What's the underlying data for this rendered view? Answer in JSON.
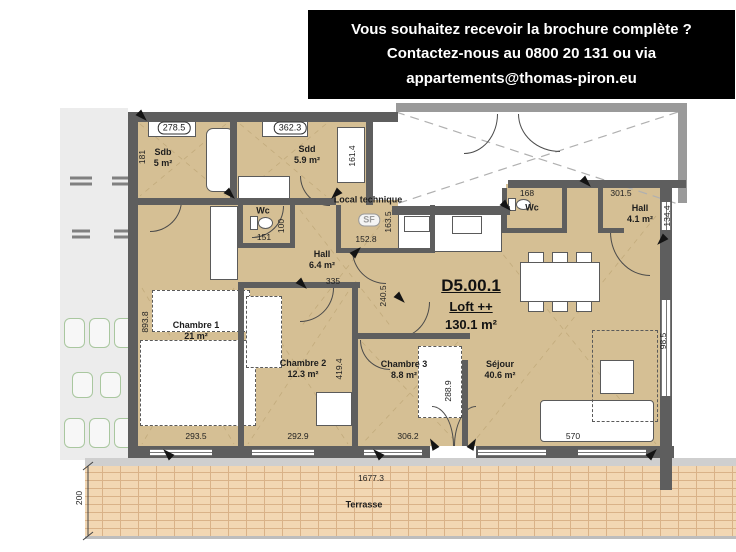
{
  "banner": {
    "lines": [
      "Vous souhaitez recevoir la brochure complète ?",
      "Contactez-nous au 0800 20 131 ou via",
      "appartements@thomas-piron.eu"
    ]
  },
  "unit": {
    "id": "D5.00.1",
    "type": "Loft ++",
    "area": "130.1 m²"
  },
  "rooms": [
    {
      "id": "sdb",
      "name": "Sdb",
      "area": "5 m²",
      "x": 163,
      "y": 158
    },
    {
      "id": "sdd",
      "name": "Sdd",
      "area": "5.9 m²",
      "x": 307,
      "y": 155
    },
    {
      "id": "wc-left",
      "name": "Wc",
      "area": "",
      "x": 263,
      "y": 211
    },
    {
      "id": "local-technique",
      "name": "Local technique",
      "area": "",
      "x": 368,
      "y": 200
    },
    {
      "id": "hall",
      "name": "Hall",
      "area": "6.4 m²",
      "x": 322,
      "y": 260
    },
    {
      "id": "chambre-1",
      "name": "Chambre 1",
      "area": "21 m²",
      "x": 196,
      "y": 331
    },
    {
      "id": "chambre-2",
      "name": "Chambre 2",
      "area": "12.3 m²",
      "x": 303,
      "y": 369
    },
    {
      "id": "chambre-3",
      "name": "Chambre 3",
      "area": "8.8 m²",
      "x": 404,
      "y": 370
    },
    {
      "id": "sejour",
      "name": "Séjour",
      "area": "40.6 m²",
      "x": 500,
      "y": 370
    },
    {
      "id": "wc-right",
      "name": "Wc",
      "area": "",
      "x": 532,
      "y": 208
    },
    {
      "id": "hall-right",
      "name": "Hall",
      "area": "4.1 m²",
      "x": 640,
      "y": 214
    },
    {
      "id": "terrasse",
      "name": "Terrasse",
      "area": "",
      "x": 364,
      "y": 505
    }
  ],
  "dimensions": [
    {
      "text": "278.5",
      "x": 174,
      "y": 128,
      "boxed": true
    },
    {
      "text": "362.3",
      "x": 290,
      "y": 128,
      "boxed": true
    },
    {
      "text": "181",
      "x": 142,
      "y": 157,
      "vertical": true
    },
    {
      "text": "161.4",
      "x": 352,
      "y": 156,
      "vertical": true
    },
    {
      "text": "151",
      "x": 264,
      "y": 237
    },
    {
      "text": "100",
      "x": 281,
      "y": 226,
      "vertical": true
    },
    {
      "text": "152.8",
      "x": 366,
      "y": 239
    },
    {
      "text": "163.5",
      "x": 388,
      "y": 222,
      "vertical": true
    },
    {
      "text": "335",
      "x": 333,
      "y": 281
    },
    {
      "text": "240.5",
      "x": 383,
      "y": 296,
      "vertical": true
    },
    {
      "text": "893.8",
      "x": 145,
      "y": 322,
      "vertical": true
    },
    {
      "text": "419.4",
      "x": 339,
      "y": 369,
      "vertical": true
    },
    {
      "text": "288.9",
      "x": 448,
      "y": 391,
      "vertical": true
    },
    {
      "text": "293.5",
      "x": 196,
      "y": 436
    },
    {
      "text": "292.9",
      "x": 298,
      "y": 436
    },
    {
      "text": "306.2",
      "x": 408,
      "y": 436
    },
    {
      "text": "570",
      "x": 573,
      "y": 436
    },
    {
      "text": "168",
      "x": 527,
      "y": 193
    },
    {
      "text": "301.5",
      "x": 621,
      "y": 193
    },
    {
      "text": "134.4",
      "x": 667,
      "y": 216,
      "vertical": true
    },
    {
      "text": "98.5",
      "x": 663,
      "y": 341,
      "vertical": true
    },
    {
      "text": "1677.3",
      "x": 371,
      "y": 478
    },
    {
      "text": "200",
      "x": 79,
      "y": 498,
      "vertical": true
    },
    {
      "text": "SF",
      "x": 369,
      "y": 220,
      "boxed": true,
      "muted": true
    }
  ],
  "colors": {
    "room_fill": "#d5bf94",
    "wall": "#5e5e5e",
    "wall_light": "#9a9a9a",
    "terrace_base": "#f2d7b3",
    "terrace_line": "#d9b288",
    "side_strip": "#ececec",
    "car_outline": "#a9c79f"
  }
}
